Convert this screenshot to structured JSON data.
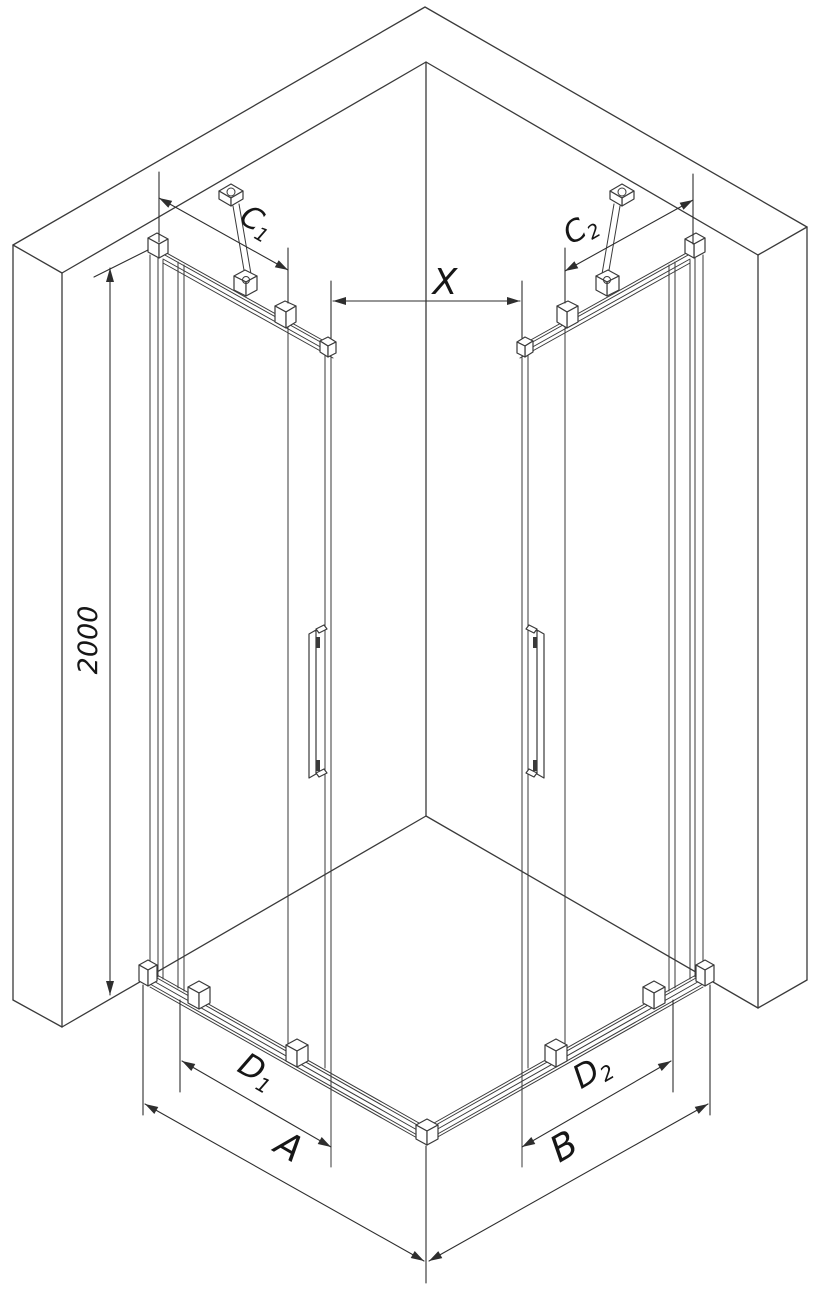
{
  "diagram": {
    "type": "technical-dimension-drawing",
    "subject": "corner shower enclosure with two sliding doors",
    "background": "#ffffff",
    "line_color": "#3a3a3a",
    "label_color": "#161616",
    "labels": {
      "height": {
        "text": "2000"
      },
      "c1": {
        "main": "C",
        "sub": "1"
      },
      "c2": {
        "main": "C",
        "sub": "2"
      },
      "x": {
        "text": "X"
      },
      "d1": {
        "main": "D",
        "sub": "1"
      },
      "d2": {
        "main": "D",
        "sub": "2"
      },
      "a": {
        "text": "A"
      },
      "b": {
        "text": "B"
      }
    }
  }
}
